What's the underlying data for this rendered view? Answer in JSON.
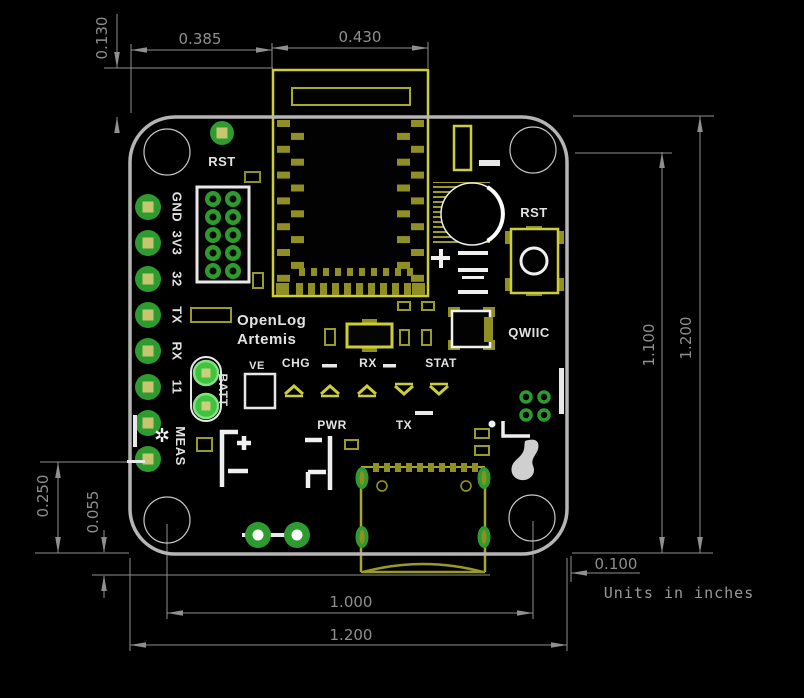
{
  "drawing": {
    "units_note": "Units in inches"
  },
  "dimensions": {
    "module_overhang_top": "0.130",
    "board_edge_to_module": "0.385",
    "module_width": "0.430",
    "hole_to_bottom_edge": "1.100",
    "board_height": "1.200",
    "edge_offset_right": "0.100",
    "hole_spacing_bottom": "1.000",
    "board_width": "1.200",
    "pin_to_bottom_edge": "0.250",
    "usb_overhang_bottom": "0.055"
  },
  "silkscreen": {
    "board_name_line1": "OpenLog",
    "board_name_line2": "Artemis",
    "reset_pad_label": "RST",
    "reset_button_label": "RST",
    "qwiic_label": "QWIIC",
    "ve_label": "VE",
    "chg_led_label": "CHG",
    "rx_led_label": "RX",
    "stat_led_label": "STAT",
    "pwr_led_label": "PWR",
    "tx_led_label": "TX",
    "battery_label": "BATT",
    "meas_jumper_label": "MEAS",
    "pin_labels": [
      "GND",
      "3V3",
      "32",
      "TX",
      "RX",
      "11"
    ]
  },
  "colors": {
    "background": "#000000",
    "board_outline": "#b5b5b5",
    "copper_olive": "#8f8f23",
    "bright_yellow": "#cdcd39",
    "pad_green": "#2d9b2d",
    "bright_green": "#3fc43f",
    "pale_hole": "#c6c671",
    "silkscreen_white": "#e2e2e2",
    "dimension_gray": "#8f8f8f"
  }
}
